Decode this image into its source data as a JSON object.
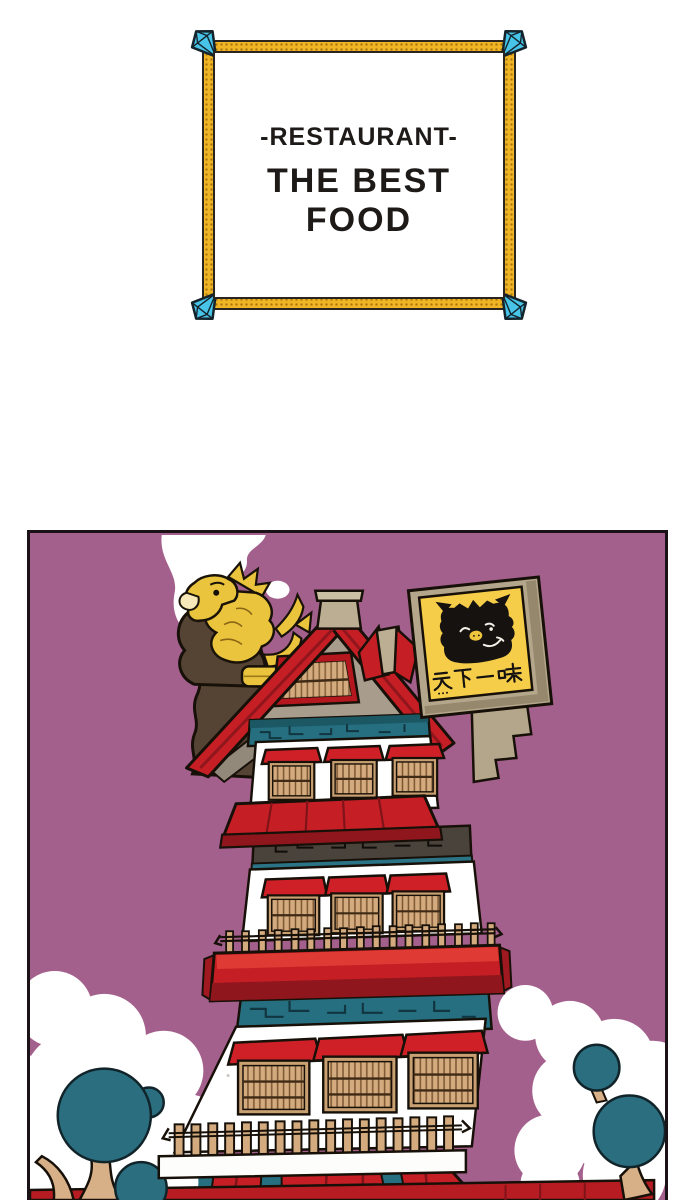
{
  "title_card": {
    "subtitle": "-RESTAURANT-",
    "title": "THE BEST FOOD"
  },
  "panel": {
    "sign": {
      "text": "天下一味",
      "sub_text": "···"
    }
  },
  "colors": {
    "panel_background": "#a4608c",
    "roof_red": "#c61e25",
    "roof_red_dark": "#8f161c",
    "brick_teal": "#256f80",
    "tree_teal": "#2b6e80",
    "wood_tan": "#d3ab7e",
    "gable_tan": "#a89c8d",
    "dark_brick": "#4a433c",
    "chimney_brown": "#554334",
    "statue_gold": "#e9c43c",
    "sign_yellow": "#f5cd48",
    "sign_frame_tan": "#b4a68a",
    "frame_gold": "#f0b524",
    "gem_cyan": "#48c4e9",
    "outline_black": "#171008"
  }
}
